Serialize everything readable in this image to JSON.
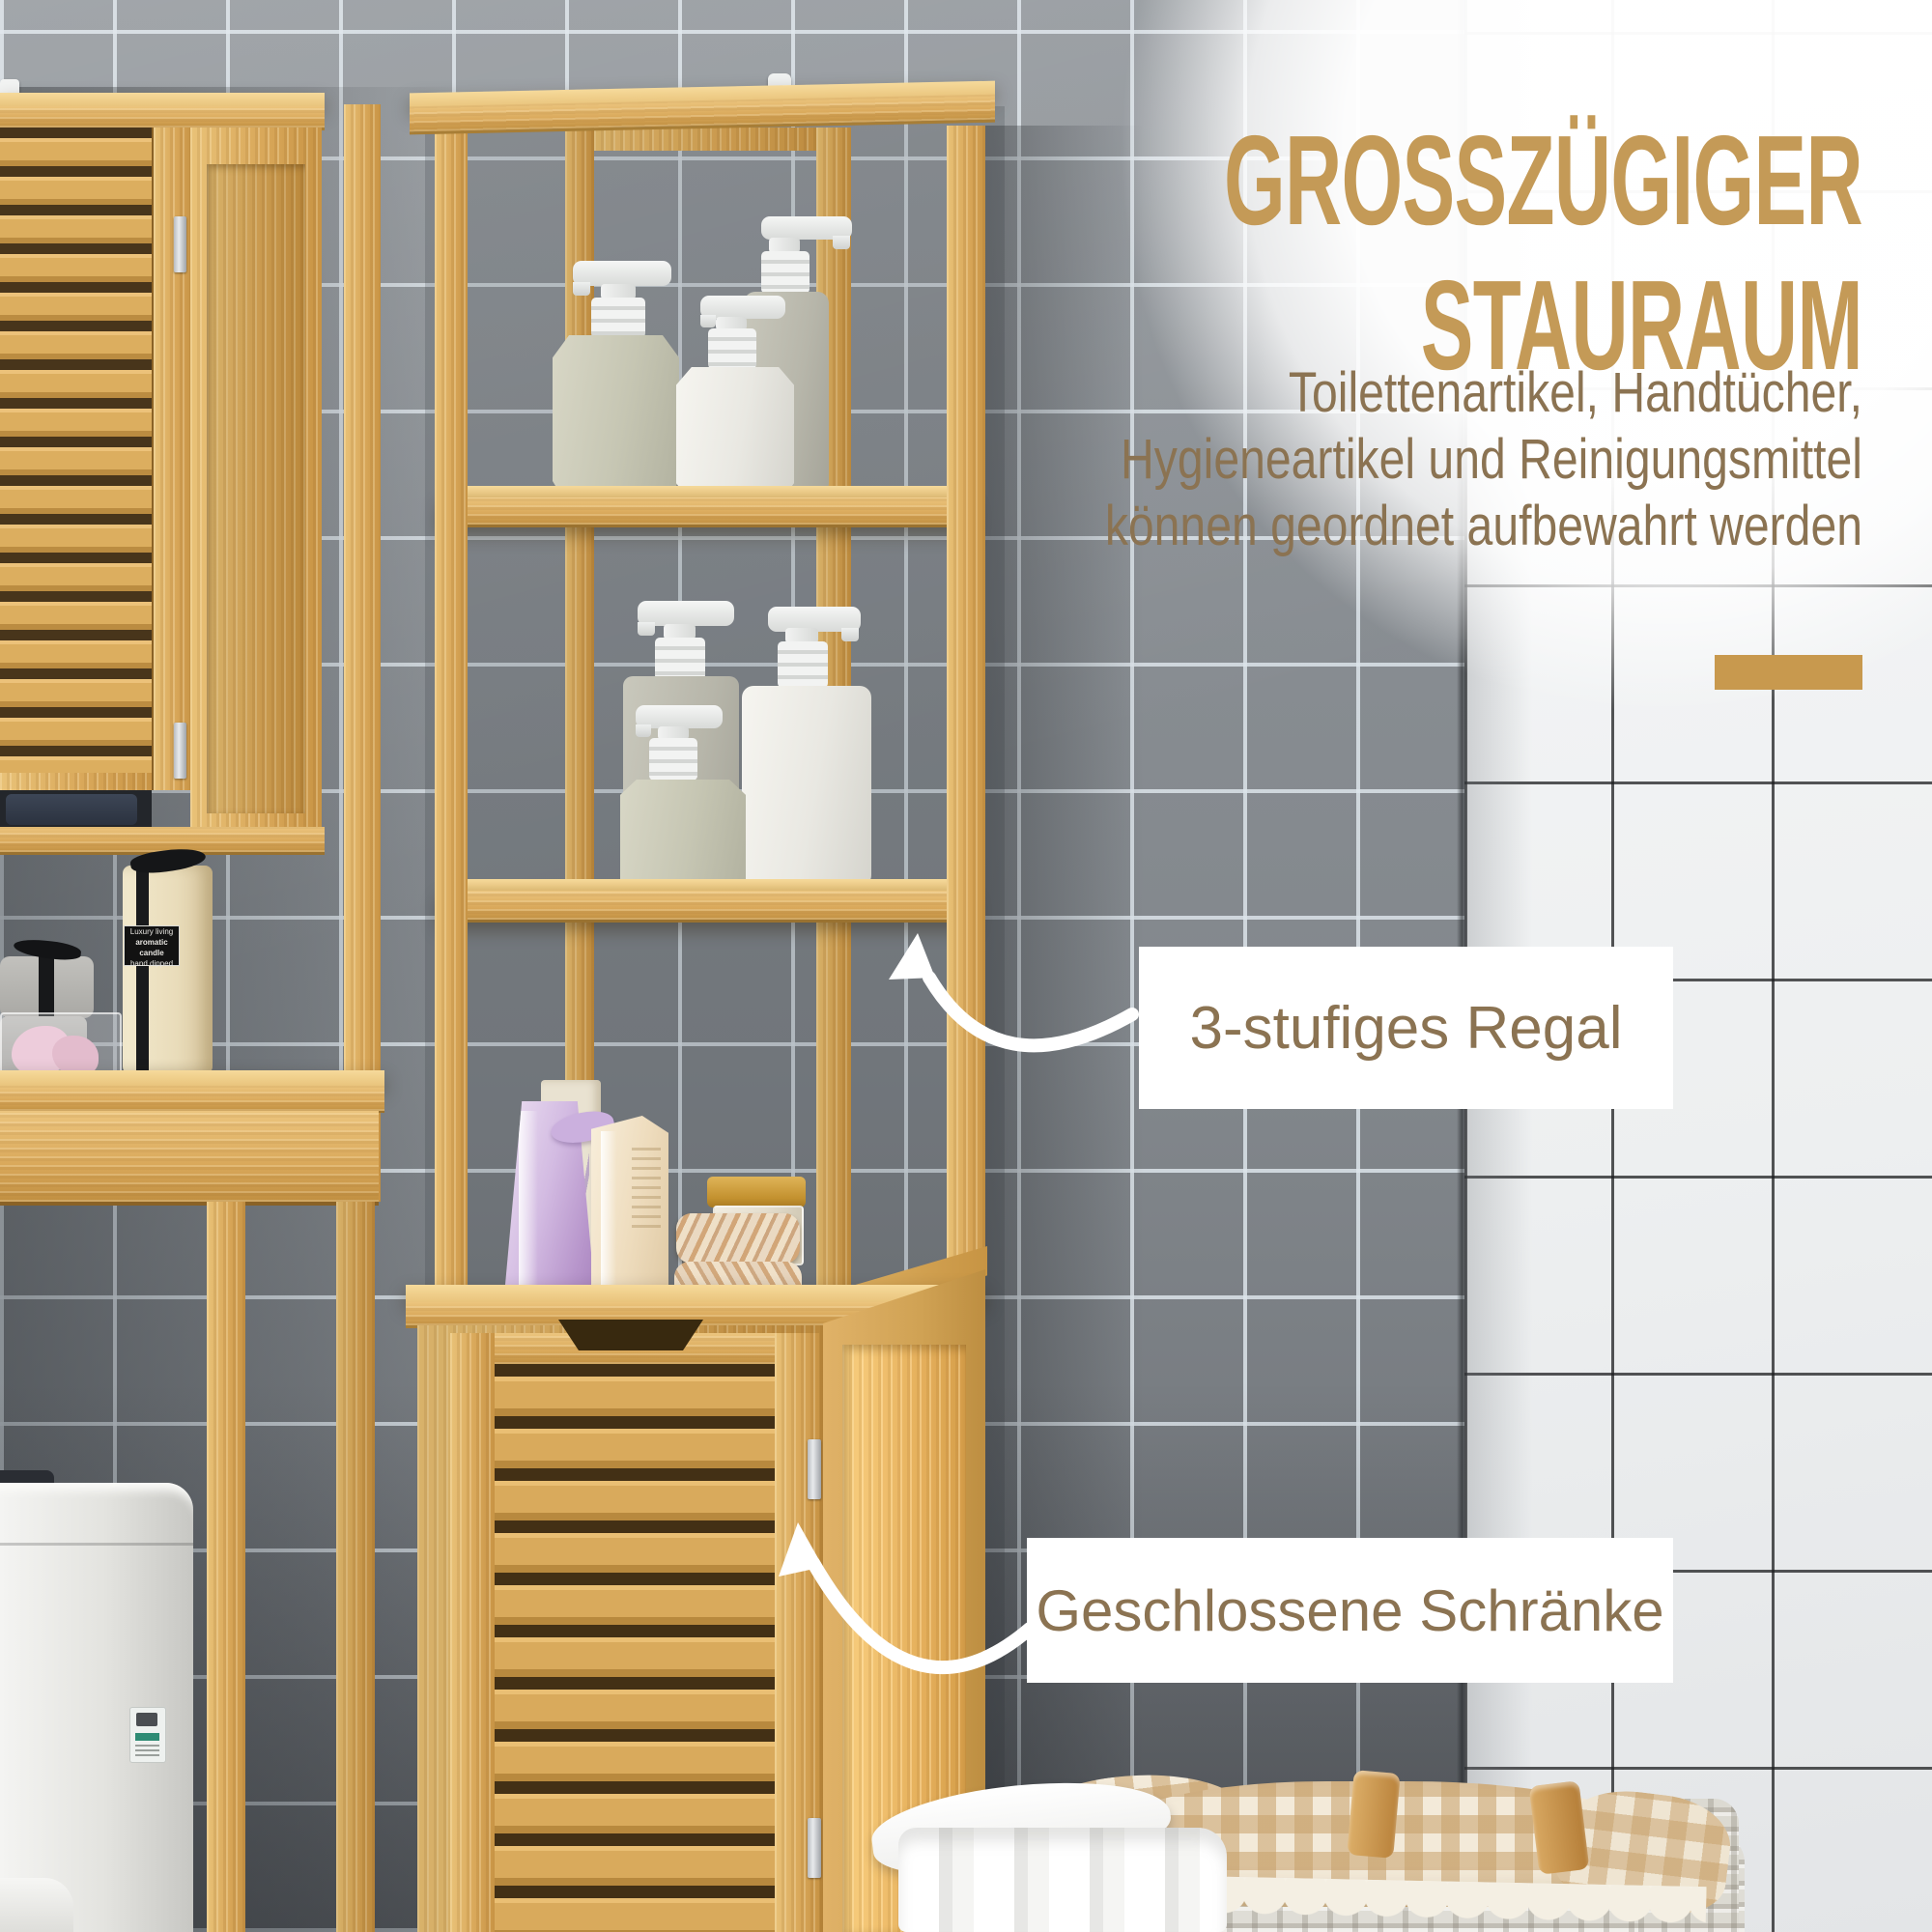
{
  "scene": {
    "headline": {
      "line1": "GROSSZÜGIGER",
      "line2": "STAURAUM"
    },
    "description": {
      "line1": "Toilettenartikel, Handtücher,",
      "line2": "Hygieneartikel und Reinigungsmittel",
      "line3": "können geordnet aufbewahrt werden"
    },
    "callout_shelf": {
      "label": "3-stufiges Regal"
    },
    "callout_cabinet": {
      "label": "Geschlossene Schränke"
    },
    "candle_label": {
      "line1": "Luxury living",
      "line2": "aromatic candle",
      "line3": "hand dipped"
    },
    "colors": {
      "headline": "#c49a57",
      "body_text": "#8b7352",
      "accent_bar": "#c8994e",
      "callout_text": "#8b7352",
      "callout_bg": "#ffffff",
      "bamboo": "#d9a85a",
      "gray_tile": "#84898e",
      "white_tile": "#f2f3f4"
    }
  }
}
